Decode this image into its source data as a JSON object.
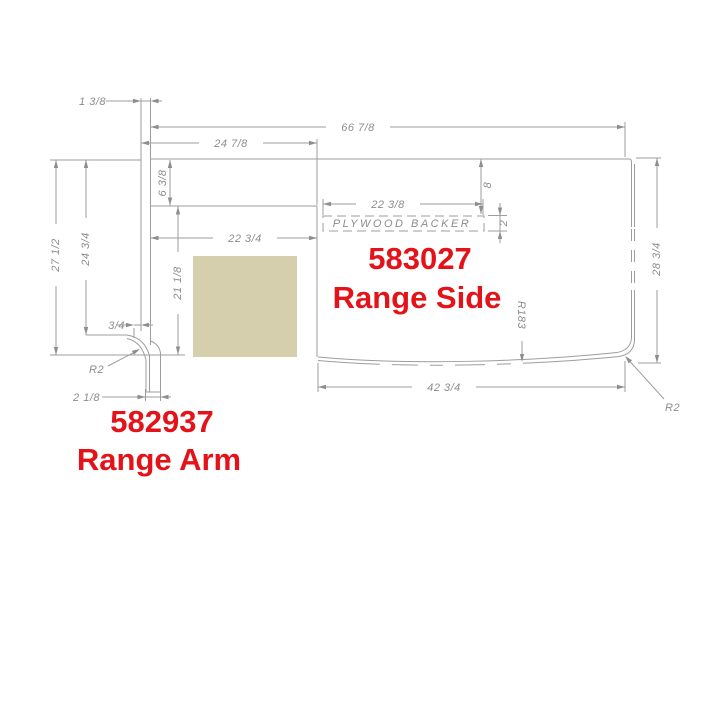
{
  "parts": {
    "range_arm": {
      "part_number": "582937",
      "part_name": "Range Arm"
    },
    "range_side": {
      "part_number": "583027",
      "part_name": "Range Side"
    }
  },
  "dimensions": {
    "arm_thickness": "1 3/8",
    "overall_width": "66 7/8",
    "left_section_width": "24 7/8",
    "top_strip_height": "6 3/8",
    "backer_width": "22 3/8",
    "backer_offset_from_top": "8",
    "backer_height": "2",
    "notch_width": "22 3/4",
    "arm_total_height": "27 1/2",
    "arm_face_height": "24 3/4",
    "notch_height": "21 1/8",
    "side_depth": "28 3/4",
    "arm_lip": "3/4",
    "arm_foot_radius": "R2",
    "arm_foot_width": "2 1/8",
    "front_curve_width": "42 3/4",
    "front_curve_radius": "R183",
    "corner_radius": "R2"
  },
  "annotations": {
    "plywood_backer": "PLYWOOD BACKER"
  },
  "colors": {
    "label_red": "#e41219",
    "line_gray": "#9d9d9d",
    "dim_text_gray": "#8c8c8c",
    "swatch_beige": "#d5cfad"
  }
}
